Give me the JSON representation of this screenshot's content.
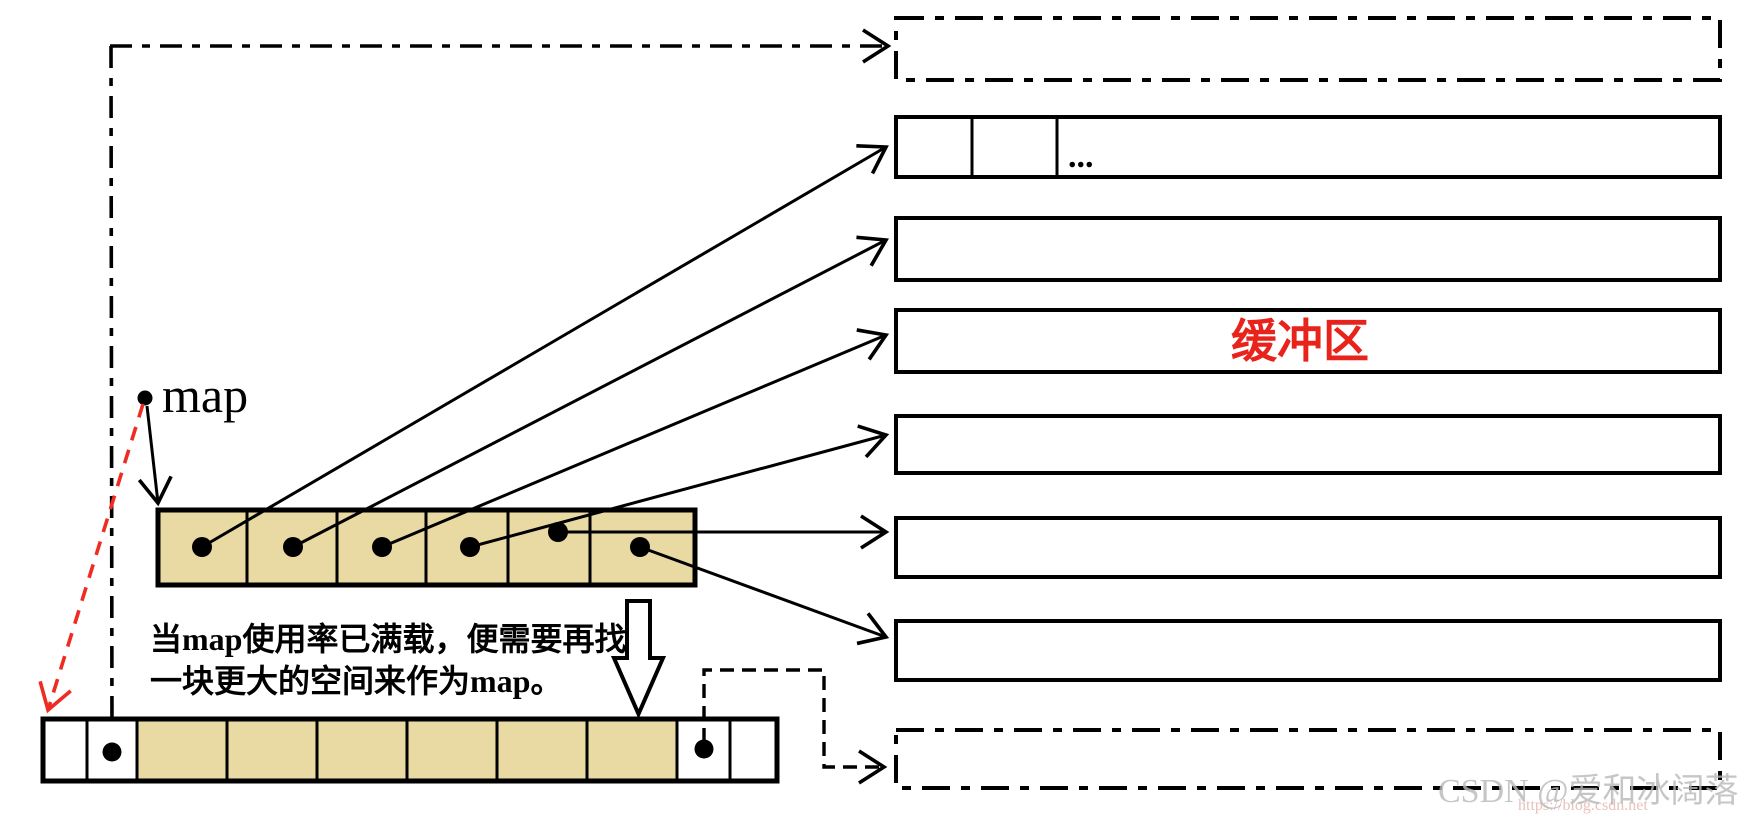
{
  "diagram": {
    "map_label": "map",
    "buffer_label": "缓冲区",
    "ellipsis": "...",
    "caption_line1": "当map使用率已满载，便需要再找",
    "caption_line2": "一块更大的空间来作为map。",
    "map_cell_count": 6,
    "map_pointer_dot_count": 6,
    "buffer_count": 8,
    "buffer_styles": [
      "dash-dot",
      "solid-with-cells",
      "solid",
      "solid-labeled",
      "solid",
      "solid",
      "solid",
      "dash-dot"
    ],
    "new_map_cell_count": 10,
    "new_map_dot_count": 2
  },
  "watermark": {
    "text": "CSDN @爱和冰阔落",
    "url": "https://blog.csdn.net"
  },
  "colors": {
    "cell_fill": "#e9d9a3",
    "buffer_label_red": "#e8231b",
    "red_arrow": "#ee2c22",
    "ink": "#000000",
    "watermark_gray": "#b9b9b9",
    "watermark_url_pink": "#e3b7ae"
  }
}
